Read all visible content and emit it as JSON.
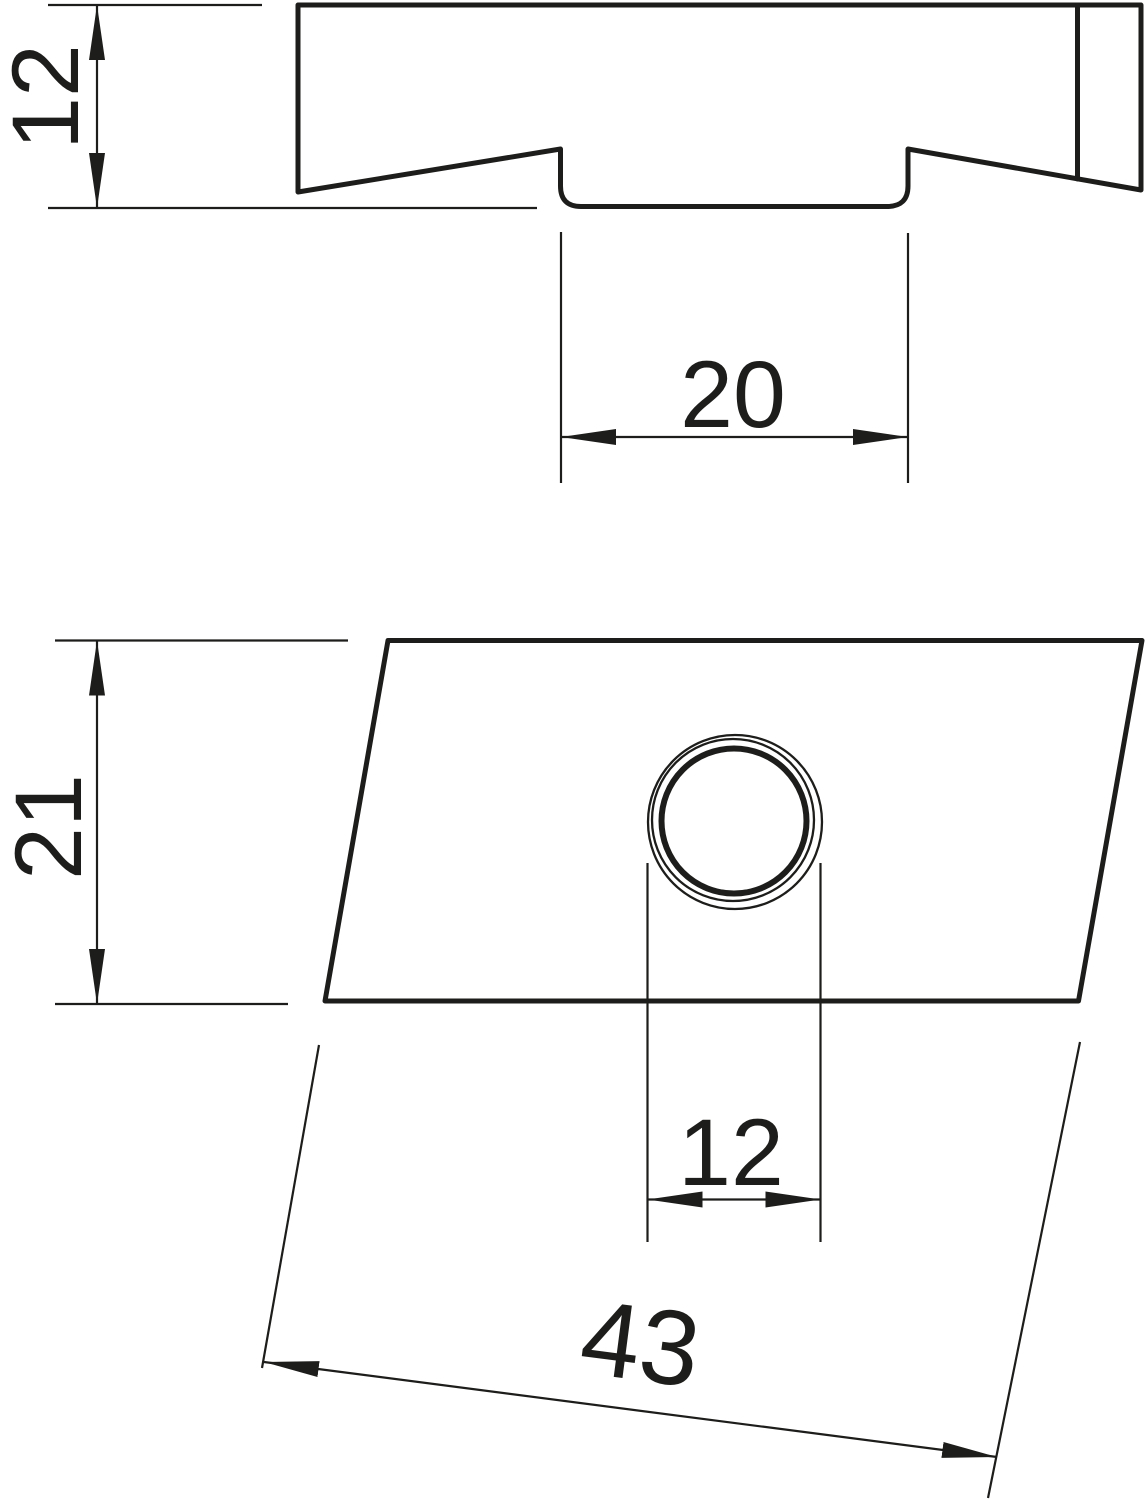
{
  "drawing": {
    "type": "technical-dimension-drawing",
    "background_color": "#ffffff",
    "line_color": "#1d1d1b",
    "views": {
      "profile": {
        "description": "side profile of channel nut",
        "dimensions": {
          "height": {
            "value": "12"
          },
          "channel_width": {
            "value": "20"
          }
        }
      },
      "plan": {
        "description": "top plan view with threaded hole",
        "dimensions": {
          "width": {
            "value": "21"
          },
          "hole_diameter": {
            "value": "12"
          },
          "length": {
            "value": "43"
          }
        }
      }
    }
  }
}
